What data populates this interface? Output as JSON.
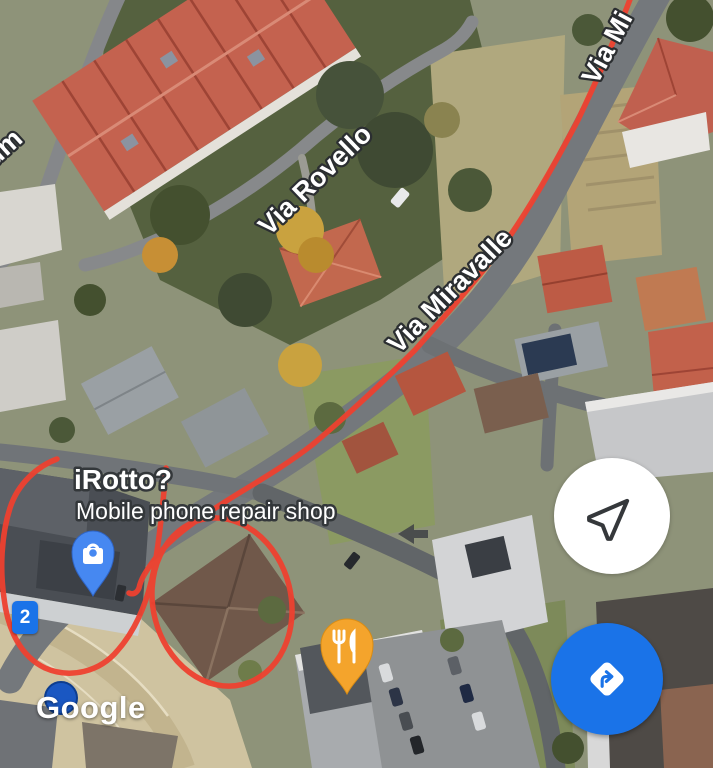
{
  "map": {
    "type": "satellite",
    "streets": {
      "partial_top_left": "um",
      "via_rovello": "Via Rovello",
      "via_miravalle": "Via Miravalle",
      "via_mi_partial": "Via Mi"
    },
    "poi": {
      "name": "iRotto?",
      "category": "Mobile phone repair shop",
      "pin_icon": "shopping-bag-pin",
      "pin_color": "#4688F1"
    },
    "restaurant_poi": {
      "pin_icon": "restaurant-pin",
      "pin_color": "#F4A42C"
    },
    "route_marker": {
      "label": "2",
      "color": "#1A73E8"
    },
    "annotations": {
      "color": "#EE4130",
      "shapes": [
        "route-line-along-via-miravalle",
        "loop-around-repair-shop",
        "circle-around-building"
      ]
    },
    "road_marking": "left-arrow"
  },
  "controls": {
    "locate_button": {
      "icon": "navigation-arrow-icon",
      "bg": "#FFFFFF"
    },
    "directions_button": {
      "icon": "directions-icon",
      "bg": "#1A73E8"
    }
  },
  "watermark": {
    "logo_text": "Google"
  }
}
